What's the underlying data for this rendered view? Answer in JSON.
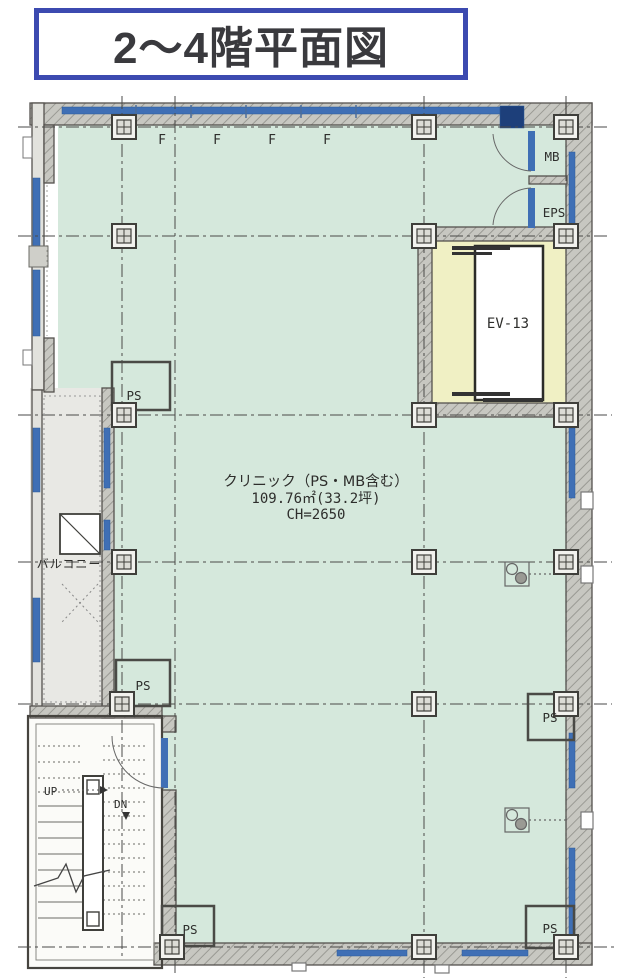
{
  "title": "2〜4階平面図",
  "plan": {
    "room_label": "クリニック（PS・MB含む）",
    "room_area": "109.76㎡(33.2坪)",
    "room_ceiling": "CH=2650",
    "elevator": "EV-13",
    "meter_box": "MB",
    "eps": "EPS",
    "pipe_space": "PS",
    "balcony": "バルコニー",
    "stairs_up": "UP",
    "stairs_down": "DN",
    "window_mark": "F"
  },
  "colors": {
    "title_border_blue": "#3c4ab0",
    "room_green": "#d5e8dc",
    "elevator_yellow": "#f0f0c4",
    "window_blue": "#3f6fb5",
    "wall_gray": "#c7c7c1",
    "balcony_gray": "#e8e8e4"
  }
}
